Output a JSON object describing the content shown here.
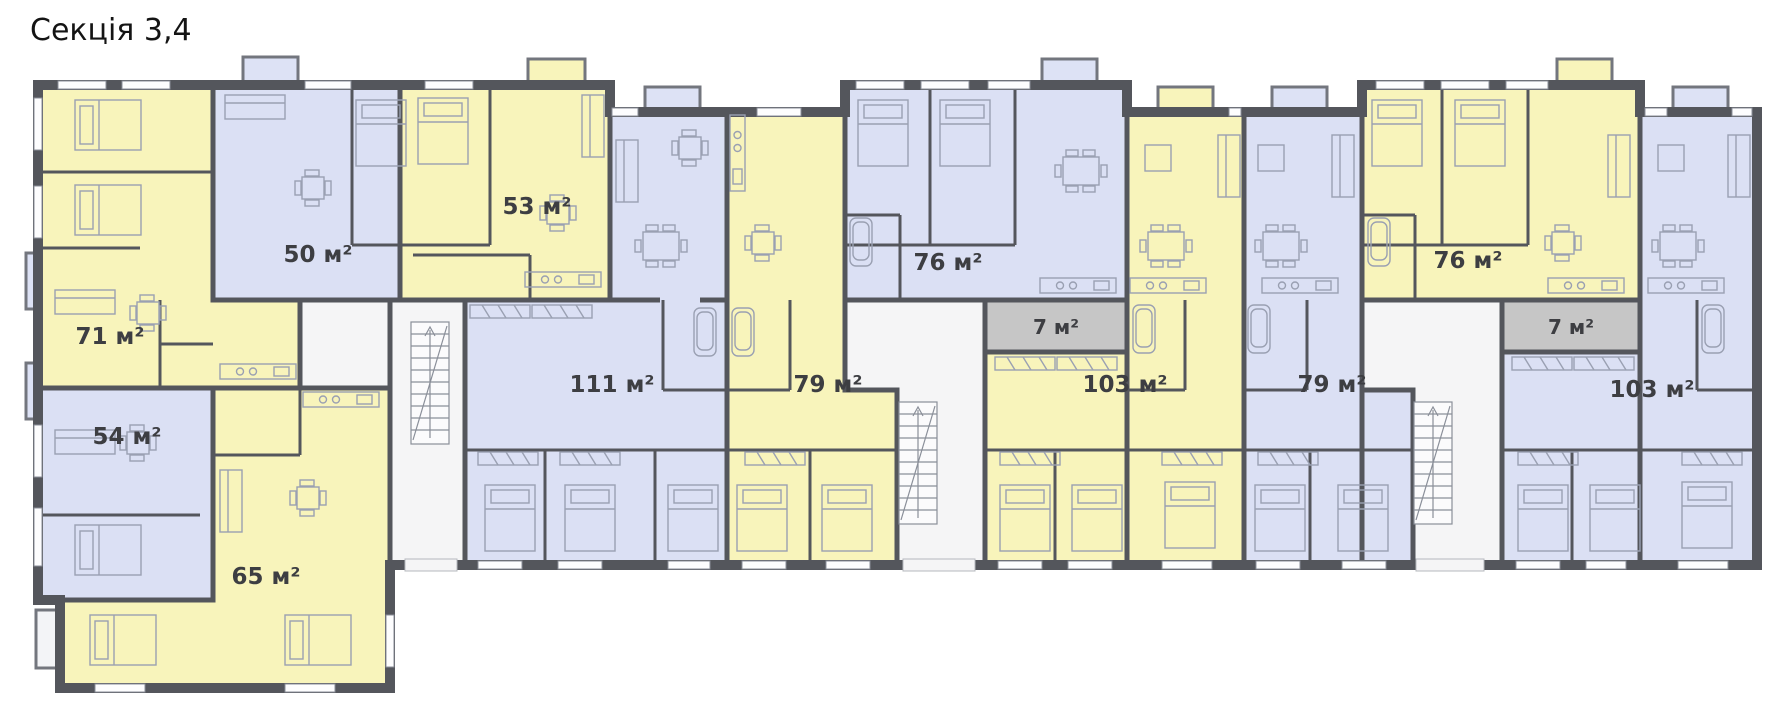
{
  "title": "Секція 3,4",
  "apartments": [
    {
      "id": "71",
      "area": "71 м²",
      "color": "yellow"
    },
    {
      "id": "50",
      "area": "50 м²",
      "color": "blue"
    },
    {
      "id": "53",
      "area": "53 м²",
      "color": "yellow"
    },
    {
      "id": "54",
      "area": "54 м²",
      "color": "blue"
    },
    {
      "id": "65",
      "area": "65 м²",
      "color": "yellow"
    },
    {
      "id": "111",
      "area": "111 м²",
      "color": "blue"
    },
    {
      "id": "79-left",
      "area": "79 м²",
      "color": "yellow"
    },
    {
      "id": "76-left",
      "area": "76 м²",
      "color": "blue"
    },
    {
      "id": "103-left",
      "area": "103 м²",
      "color": "yellow"
    },
    {
      "id": "76-right",
      "area": "76 м²",
      "color": "yellow"
    },
    {
      "id": "79-right",
      "area": "79 м²",
      "color": "blue"
    },
    {
      "id": "103-right",
      "area": "103 м²",
      "color": "blue"
    }
  ],
  "storage_rooms": [
    {
      "id": "7-left",
      "area": "7 м²"
    },
    {
      "id": "7-right",
      "area": "7 м²"
    }
  ],
  "colors": {
    "apartment_yellow": "#f8f4bb",
    "apartment_blue": "#dbe0f4",
    "storage_gray": "#c6c6c6",
    "walls": "#54565c",
    "corridor_white": "#f5f5f6",
    "label_text": "#3d3e42"
  }
}
